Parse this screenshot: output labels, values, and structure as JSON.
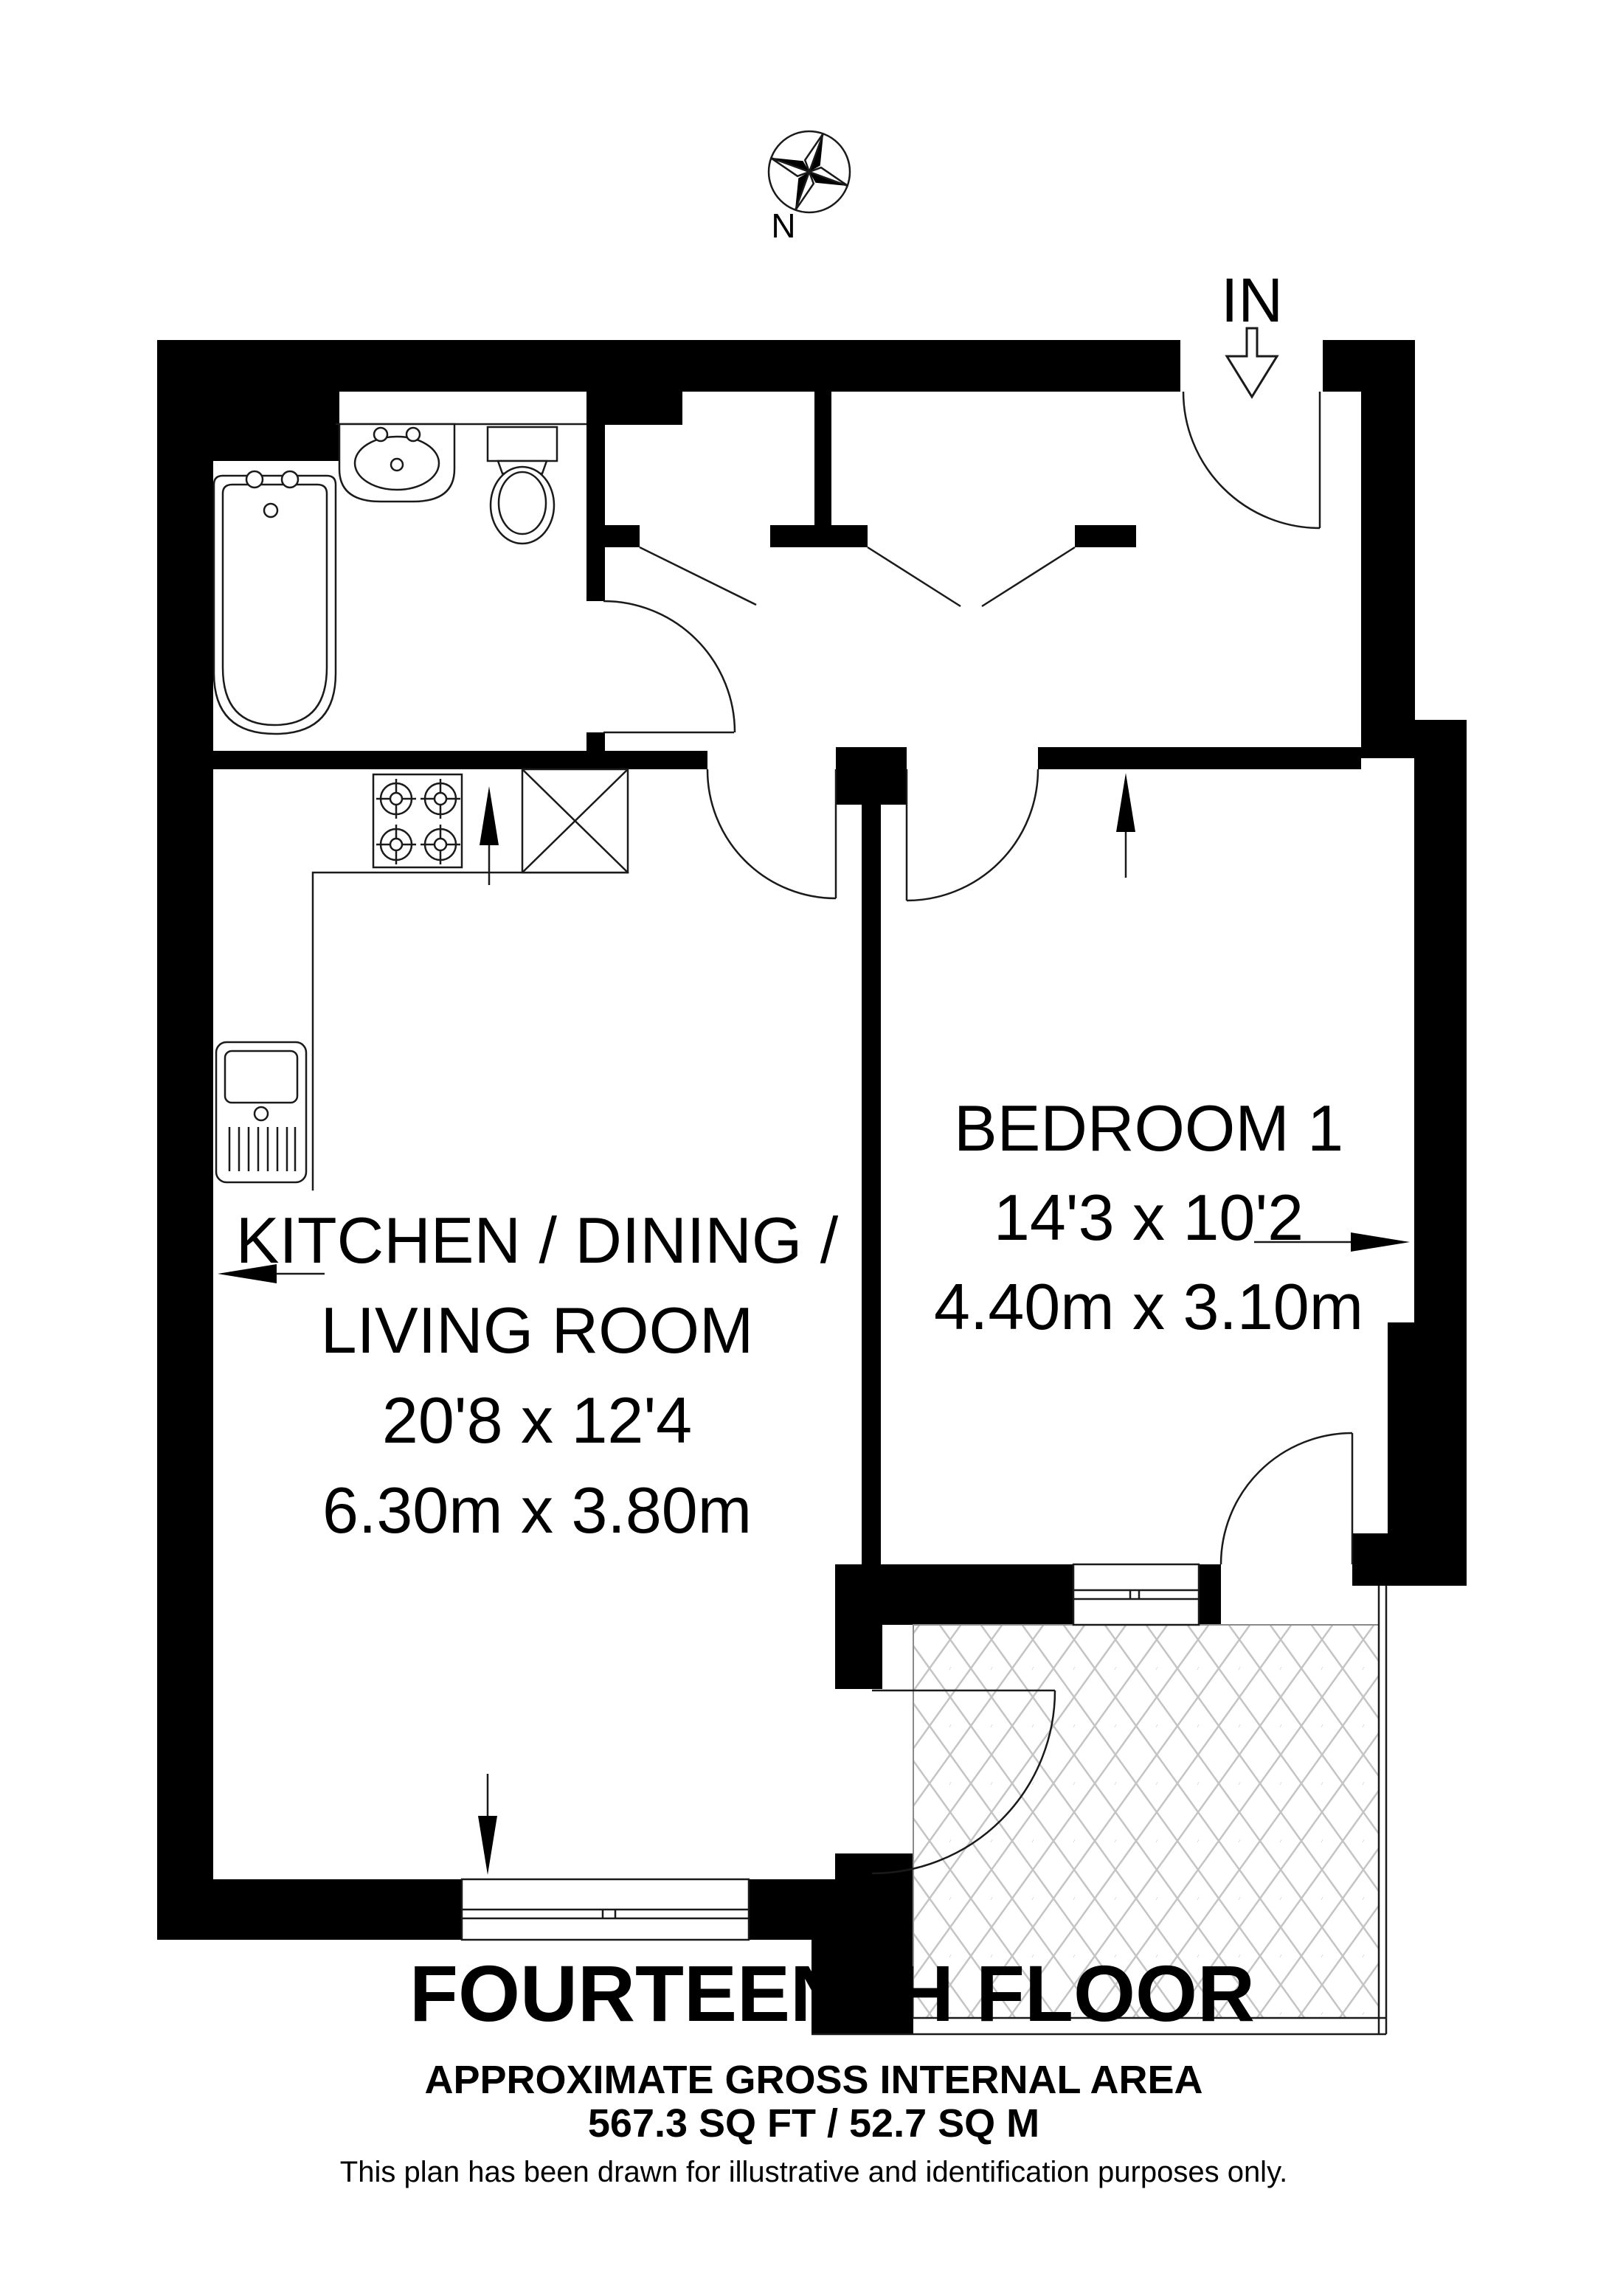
{
  "compass": {
    "label": "N"
  },
  "entrance": {
    "label": "IN"
  },
  "rooms": [
    {
      "id": "kitchen-dining-living",
      "name_line1": "KITCHEN / DINING /",
      "name_line2": "LIVING ROOM",
      "dims_imperial": "20'8 x 12'4",
      "dims_metric": "6.30m x 3.80m"
    },
    {
      "id": "bedroom-1",
      "name_line1": "BEDROOM 1",
      "dims_imperial": "14'3 x 10'2",
      "dims_metric": "4.40m x 3.10m"
    }
  ],
  "footer": {
    "floor_title": "FOURTEENTH FLOOR",
    "area_heading": "APPROXIMATE GROSS INTERNAL AREA",
    "area_value": "567.3 SQ FT / 52.7 SQ M",
    "disclaimer": "This plan has been drawn for illustrative and identification purposes only."
  },
  "colors": {
    "wall": "#000000",
    "line": "#1a1a1a",
    "hatch": "#c4c4c4",
    "background": "#ffffff"
  }
}
